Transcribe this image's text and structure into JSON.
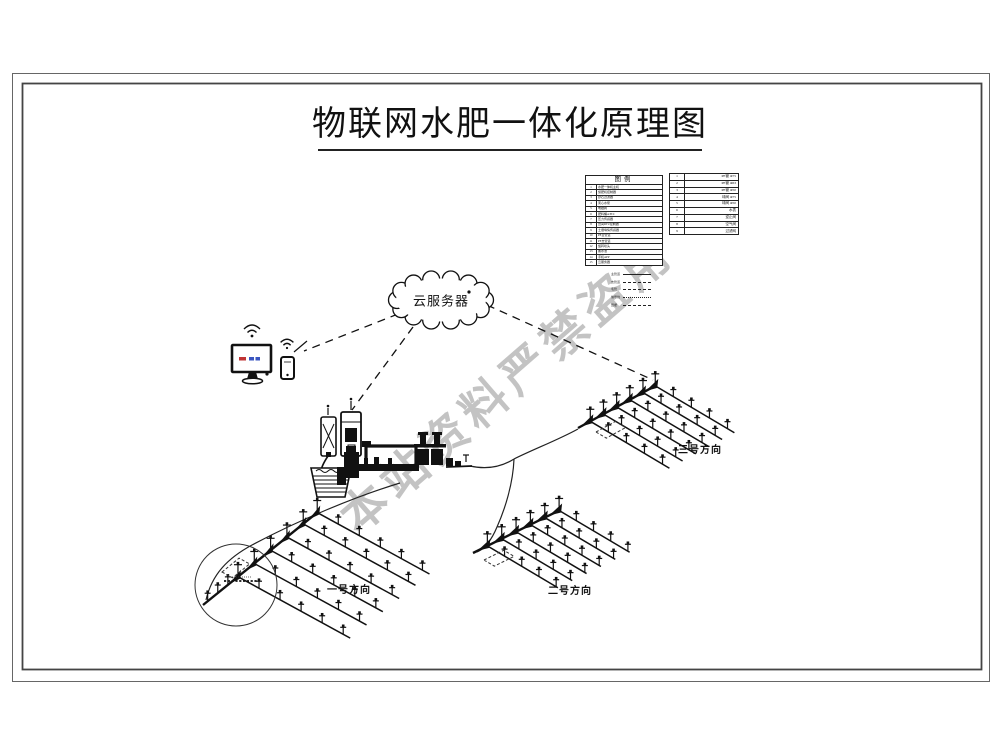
{
  "title": {
    "text": "物联网水肥一体化原理图"
  },
  "watermark": {
    "text": "本站资料严禁盗用",
    "color": "#b9b9b9"
  },
  "cloud": {
    "label": "云服务器"
  },
  "legend": {
    "title": "图例",
    "main_rows": [
      [
        "1",
        "水肥一体机主机"
      ],
      [
        "2",
        "施肥机控制器"
      ],
      [
        "3",
        "砂石过滤器"
      ],
      [
        "4",
        "离心水泵"
      ],
      [
        "5",
        "电磁阀"
      ],
      [
        "6",
        "肥料桶A/B/C"
      ],
      [
        "7",
        "压力传感器"
      ],
      [
        "8",
        "田间RTU控制器"
      ],
      [
        "9",
        "土壤墒情传感器"
      ],
      [
        "10",
        "PE主管道"
      ],
      [
        "11",
        "PE支管道"
      ],
      [
        "12",
        "旋转喷头"
      ],
      [
        "13",
        "蓄水池"
      ],
      [
        "14",
        "手机APP"
      ],
      [
        "15",
        "云服务器"
      ]
    ],
    "pipe_rows": [
      [
        "1",
        "PE管 Φ75"
      ],
      [
        "2",
        "PE管 Φ63"
      ],
      [
        "3",
        "PE管 Φ50"
      ],
      [
        "4",
        "球阀 Φ75"
      ],
      [
        "5",
        "球阀 Φ50"
      ],
      [
        "6",
        "水表"
      ],
      [
        "7",
        "逆止阀"
      ],
      [
        "8",
        "空气阀"
      ],
      [
        "9",
        "过滤网"
      ]
    ],
    "line_rows": [
      {
        "label": "主管道",
        "style": "solid"
      },
      {
        "label": "支管道",
        "style": "dashed"
      },
      {
        "label": "毛管",
        "style": "dashed"
      },
      {
        "label": "信号线",
        "style": "dotted"
      },
      {
        "label": "田埂",
        "style": "dashed"
      }
    ]
  },
  "fields": [
    {
      "label": "一号方向"
    },
    {
      "label": "二号方向"
    },
    {
      "label": "三号方向"
    }
  ],
  "colors": {
    "line": "#111111",
    "frame": "#555555",
    "watermark": "#b9b9b9",
    "screen_red": "#c03434",
    "screen_blue": "#3a55c0"
  }
}
